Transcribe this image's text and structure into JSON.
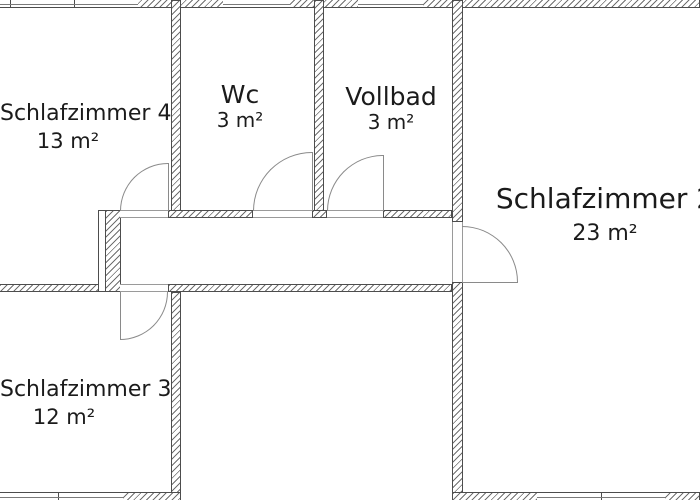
{
  "plan_title": "floor-plan",
  "colors": {
    "background": "#ffffff",
    "wall_outline": "#4d4d4d",
    "wall_hatch": "#6f6f6f",
    "door_line": "#8a8a8a",
    "text": "#1b1b1b"
  },
  "rooms": [
    {
      "id": "schlafzimmer-4",
      "name": "Schlafzimmer 4",
      "area": "13 m²"
    },
    {
      "id": "wc",
      "name": "Wc",
      "area": "3 m²"
    },
    {
      "id": "vollbad",
      "name": "Vollbad",
      "area": "3 m²"
    },
    {
      "id": "schlafzimmer-2",
      "name": "Schlafzimmer 2",
      "area": "23 m²"
    },
    {
      "id": "schlafzimmer-3",
      "name": "Schlafzimmer 3",
      "area": "12 m²"
    }
  ]
}
